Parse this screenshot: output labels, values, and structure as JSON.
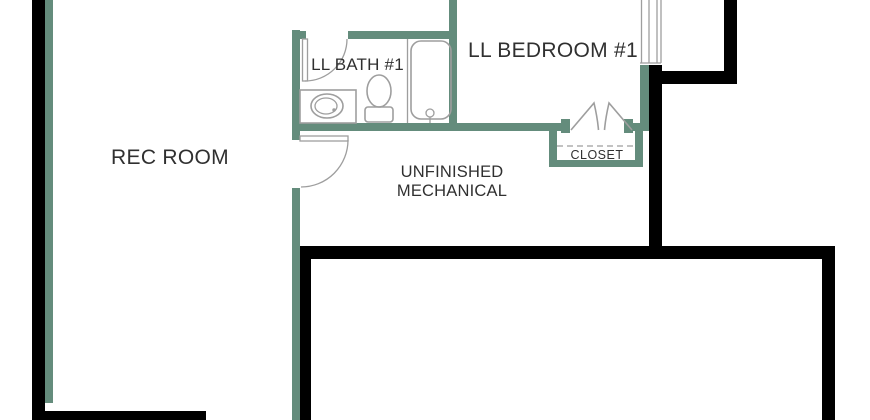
{
  "colors": {
    "wall_accent": "#648c7c",
    "wall_structure": "#000000",
    "fixture_line": "#9e9e9e",
    "label_text": "#303030",
    "background": "#ffffff"
  },
  "labels": {
    "rec_room": "REC ROOM",
    "bath": "LL BATH #1",
    "bedroom": "LL BEDROOM #1",
    "mechanical_line1": "UNFINISHED",
    "mechanical_line2": "MECHANICAL",
    "closet": "CLOSET"
  }
}
